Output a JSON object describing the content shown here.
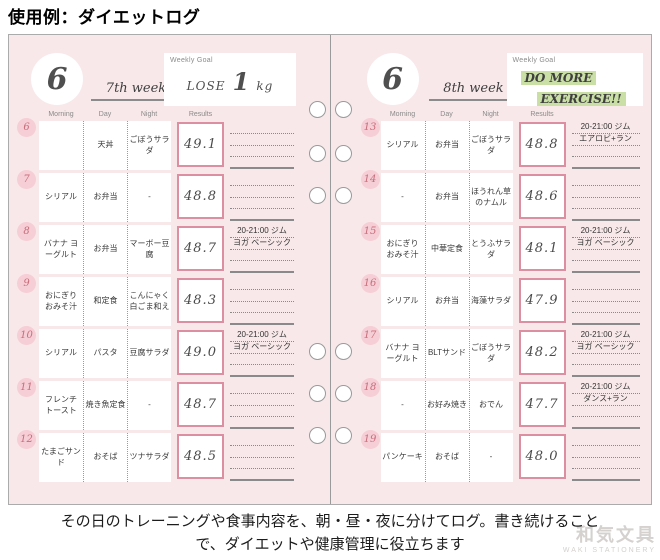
{
  "title": "使用例：ダイエットログ",
  "caption_lines": [
    "その日のトレーニングや食事内容を、朝・昼・夜に分けてログ。書き続けること",
    "で、ダイエットや健康管理に役立ちます"
  ],
  "watermark": {
    "brand": "和気文具",
    "sub": "WAKI STATIONERY"
  },
  "colors": {
    "page_pink": "#f8e8e9",
    "bubble_pink": "#f6ced5",
    "results_border_pink": "#dd8fa2",
    "highlight_green": "#c9dfa5",
    "line_gray": "#8a8a8a"
  },
  "column_headers": [
    "Morning",
    "Day",
    "Night",
    "Results"
  ],
  "pages": [
    {
      "month": "6",
      "week": "7th week",
      "goal_label": "Weekly Goal",
      "goal": {
        "style": "lose",
        "pre": "LOSE",
        "big": "1",
        "post": "kg"
      },
      "rows": [
        {
          "date": "6",
          "morning": "",
          "day": "天丼",
          "night": "ごぼうサラダ",
          "result": "49.1",
          "notes": []
        },
        {
          "date": "7",
          "morning": "シリアル",
          "day": "お弁当",
          "night": "-",
          "result": "48.8",
          "notes": []
        },
        {
          "date": "8",
          "morning": "バナナ ヨーグルト",
          "day": "お弁当",
          "night": "マーボー豆腐",
          "result": "48.7",
          "notes": [
            "20-21:00 ジム",
            "ヨガ ベーシック"
          ]
        },
        {
          "date": "9",
          "morning": "おにぎり おみそ汁",
          "day": "和定食",
          "night": "こんにゃく 白ごま和え",
          "result": "48.3",
          "notes": []
        },
        {
          "date": "10",
          "morning": "シリアル",
          "day": "パスタ",
          "night": "豆腐サラダ",
          "result": "49.0",
          "notes": [
            "20-21:00 ジム",
            "ヨガ ベーシック"
          ]
        },
        {
          "date": "11",
          "morning": "フレンチ トースト",
          "day": "焼き魚定食",
          "night": "-",
          "result": "48.7",
          "notes": []
        },
        {
          "date": "12",
          "morning": "たまごサンド",
          "day": "おそば",
          "night": "ツナサラダ",
          "result": "48.5",
          "notes": []
        }
      ]
    },
    {
      "month": "6",
      "week": "8th week",
      "goal_label": "Weekly Goal",
      "goal": {
        "style": "highlight",
        "lines": [
          "DO MORE",
          "EXERCISE!!"
        ]
      },
      "rows": [
        {
          "date": "13",
          "morning": "シリアル",
          "day": "お弁当",
          "night": "ごぼうサラダ",
          "result": "48.8",
          "notes": [
            "20-21:00 ジム",
            "エアロビ+ラン"
          ]
        },
        {
          "date": "14",
          "morning": "-",
          "day": "お弁当",
          "night": "ほうれん草 のナムル",
          "result": "48.6",
          "notes": []
        },
        {
          "date": "15",
          "morning": "おにぎり おみそ汁",
          "day": "中華定食",
          "night": "とうふサラダ",
          "result": "48.1",
          "notes": [
            "20-21:00 ジム",
            "ヨガ ベーシック"
          ]
        },
        {
          "date": "16",
          "morning": "シリアル",
          "day": "お弁当",
          "night": "海藻サラダ",
          "result": "47.9",
          "notes": []
        },
        {
          "date": "17",
          "morning": "バナナ ヨーグルト",
          "day": "BLTサンド",
          "night": "ごぼうサラダ",
          "result": "48.2",
          "notes": [
            "20-21:00 ジム",
            "ヨガ ベーシック"
          ]
        },
        {
          "date": "18",
          "morning": "-",
          "day": "お好み焼き",
          "night": "おでん",
          "result": "47.7",
          "notes": [
            "20-21:00 ジム",
            "ダンス+ラン"
          ]
        },
        {
          "date": "19",
          "morning": "パンケーキ",
          "day": "おそば",
          "night": "-",
          "result": "48.0",
          "notes": []
        }
      ]
    }
  ]
}
